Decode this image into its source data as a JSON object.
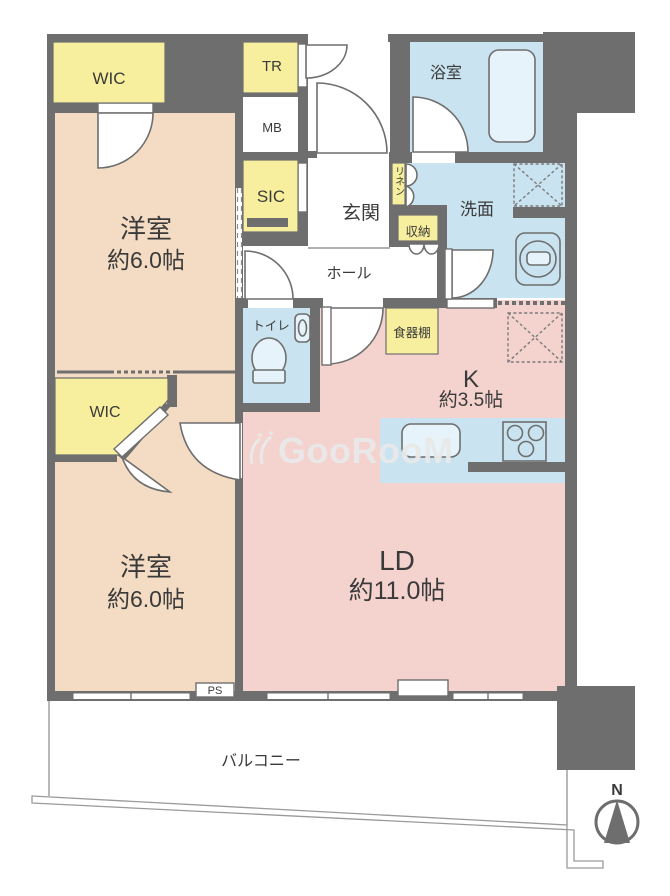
{
  "colors": {
    "wall": "#6e6e6e",
    "room_tan": "#f3dcc3",
    "room_pink": "#f4d2cd",
    "room_blue": "#c9e4f0",
    "closet_yellow": "#f7ef9e",
    "fixture_fill": "#e7f3fa",
    "line_gray": "#9a9a9a",
    "dash": "#7b7b7b",
    "text": "#3a3a3a",
    "watermark": "#e9e9e9"
  },
  "rooms": {
    "bedroom1": {
      "name": "洋室",
      "size": "約6.0帖"
    },
    "bedroom2": {
      "name": "洋室",
      "size": "約6.0帖"
    },
    "living": {
      "name": "LD",
      "size": "約11.0帖"
    },
    "kitchen": {
      "name": "K",
      "size": "約3.5帖"
    },
    "entrance": "玄関",
    "hall": "ホール",
    "bathroom": "浴室",
    "washroom": "洗面",
    "toilet": "トイレ",
    "balcony": "バルコニー"
  },
  "closets": {
    "wic1": "WIC",
    "wic2": "WIC",
    "trunk": "TR",
    "meter_box": "MB",
    "sic": "SIC",
    "linen": "リネン",
    "storage": "収納",
    "cupboard": "食器棚",
    "pipe_space": "PS"
  },
  "compass": {
    "north": "N"
  },
  "watermark": {
    "text": "GooRooM"
  }
}
